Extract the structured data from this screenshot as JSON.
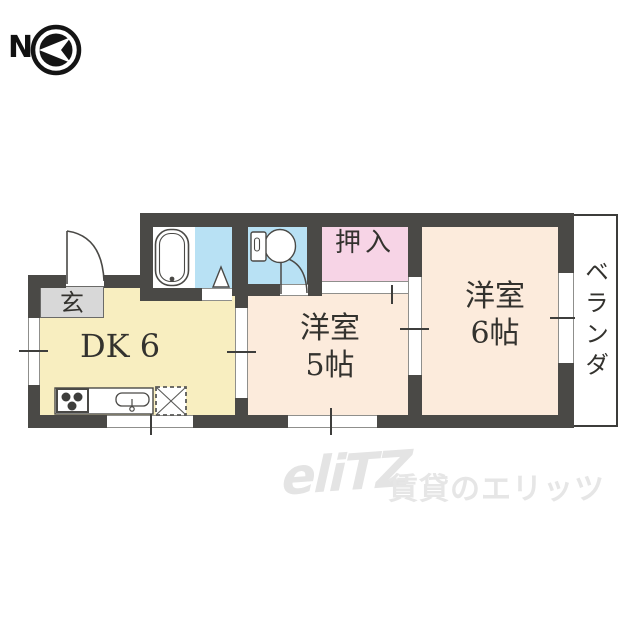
{
  "north_indicator": {
    "label": "N",
    "icon": "compass-arrow-icon"
  },
  "rooms": {
    "genkan": {
      "label": "玄"
    },
    "dk": {
      "label": "DK 6"
    },
    "western_room_5": {
      "name_line": "洋室",
      "size_line": "5帖"
    },
    "western_room_6": {
      "name_line": "洋室",
      "size_line": "6帖"
    },
    "oshiire": {
      "label": "押入"
    },
    "veranda": {
      "label": "ベランダ"
    }
  },
  "fixtures": {
    "bathtub": "bathtub-icon",
    "toilet": "toilet-icon",
    "stove": "stove-burners-icon",
    "sink": "kitchen-sink-icon",
    "refrigerator_space": "refrigerator-space-icon",
    "shower_corner": "corner-triangle-icon",
    "entrance_door": "door-swing-icon",
    "toilet_door": "door-swing-icon"
  },
  "watermark": {
    "logo": "eliTZ",
    "text": "賃貸のエリッツ"
  },
  "colors": {
    "wall": "#4a4946",
    "dk_fill": "#f8eec0",
    "western_room_fill": "#fcebdc",
    "closet_fill": "#f7d4e6",
    "wet_area_fill": "#b8e1f4",
    "genkan_fill": "#d8d8d8",
    "watermark_gray": "#e5e5e5"
  }
}
